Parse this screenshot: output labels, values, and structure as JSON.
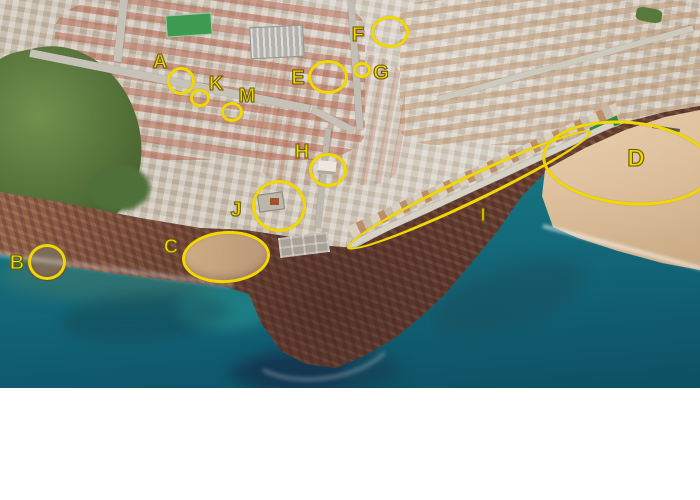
{
  "map": {
    "annotation_color": "#f2d800",
    "markers": [
      {
        "letter": "A",
        "label": "Seafront Luz Apartment",
        "lx": 160,
        "ly": 62,
        "size": 20,
        "ring": {
          "cx": 181,
          "cy": 81,
          "rx": 14,
          "ry": 14,
          "rot": 0
        }
      },
      {
        "letter": "B",
        "label": "Flat Rocks",
        "lx": 17,
        "ly": 263,
        "size": 20,
        "ring": {
          "cx": 47,
          "cy": 262,
          "rx": 19,
          "ry": 18,
          "rot": 0
        }
      },
      {
        "letter": "C",
        "label": "Prainha ( Little Beach )",
        "lx": 171,
        "ly": 247,
        "size": 20,
        "ring": {
          "cx": 226,
          "cy": 257,
          "rx": 44,
          "ry": 26,
          "rot": -4
        }
      },
      {
        "letter": "D",
        "label": "Praia da Luz",
        "lx": 636,
        "ly": 159,
        "size": 24,
        "ring": {
          "cx": 628,
          "cy": 163,
          "rx": 86,
          "ry": 42,
          "rot": 5
        }
      },
      {
        "letter": "E",
        "label": "SPAR supermarket",
        "lx": 298,
        "ly": 78,
        "size": 20,
        "ring": {
          "cx": 328,
          "cy": 77,
          "rx": 20,
          "ry": 17,
          "rot": 0
        }
      },
      {
        "letter": "F",
        "label": "BAPTISTA supermarket",
        "lx": 358,
        "ly": 35,
        "size": 20,
        "ring": {
          "cx": 390,
          "cy": 32,
          "rx": 19,
          "ry": 16,
          "rot": 0
        }
      },
      {
        "letter": "G",
        "label": "Pharmacy",
        "lx": 381,
        "ly": 73,
        "size": 20,
        "ring": {
          "cx": 362,
          "cy": 70,
          "rx": 9,
          "ry": 8,
          "rot": 0
        }
      },
      {
        "letter": "H",
        "label": "Luz Church",
        "lx": 302,
        "ly": 152,
        "size": 20,
        "ring": {
          "cx": 328,
          "cy": 170,
          "rx": 19,
          "ry": 17,
          "rot": 0
        }
      },
      {
        "letter": "I",
        "label": "Promonade",
        "lx": 483,
        "ly": 215,
        "size": 18,
        "ring": {
          "cx": 469,
          "cy": 190,
          "rx": 135,
          "ry": 14,
          "rot": -25.5
        }
      },
      {
        "letter": "J",
        "label": "Fortaleza Restaurant",
        "lx": 236,
        "ly": 210,
        "size": 20,
        "ring": {
          "cx": 279,
          "cy": 206,
          "rx": 27,
          "ry": 26,
          "rot": 0
        }
      },
      {
        "letter": "K",
        "label": "LUZDOC - medial clinic",
        "lx": 216,
        "ly": 84,
        "size": 20,
        "ring": {
          "cx": 200,
          "cy": 98,
          "rx": 10,
          "ry": 9,
          "rot": 0
        }
      },
      {
        "letter": "M",
        "label": "ROYAL GARDEN - Chinese Restaurant",
        "lx": 247,
        "ly": 96,
        "size": 20,
        "ring": {
          "cx": 232,
          "cy": 112,
          "rx": 11,
          "ry": 10,
          "rot": 0
        }
      }
    ]
  },
  "legend": {
    "items": [
      {
        "letter": "A",
        "label": "Seafront Luz Apartment"
      },
      {
        "letter": "D",
        "label": "Praia da Luz"
      },
      {
        "letter": "G",
        "label": "Pharmacy"
      },
      {
        "letter": "J",
        "label": "Fortaleza Restaurant"
      },
      {
        "letter": "B",
        "label": "Flat Rocks"
      },
      {
        "letter": "E",
        "label": "SPAR supermarket"
      },
      {
        "letter": "H",
        "label": "Luz Church"
      },
      {
        "letter": "K",
        "label": "LUZDOC - medial clinic"
      },
      {
        "letter": "C",
        "label": "Prainha ( Little Beach )"
      },
      {
        "letter": "F",
        "label": "BAPTISTA supermarket"
      },
      {
        "letter": "I",
        "label": "Promonade"
      },
      {
        "letter": "M",
        "label": "ROYAL GARDEN - Chinese Restaurant"
      }
    ]
  },
  "scene_colors": {
    "ocean_teal": "#15707e",
    "sand": "#d4ae83",
    "rock_brown": "#7c4e38",
    "town_gray": "#c9c0b2",
    "vegetation_green": "#5b7a41",
    "legend_background": "#ffffff",
    "legend_text": "#111111"
  }
}
